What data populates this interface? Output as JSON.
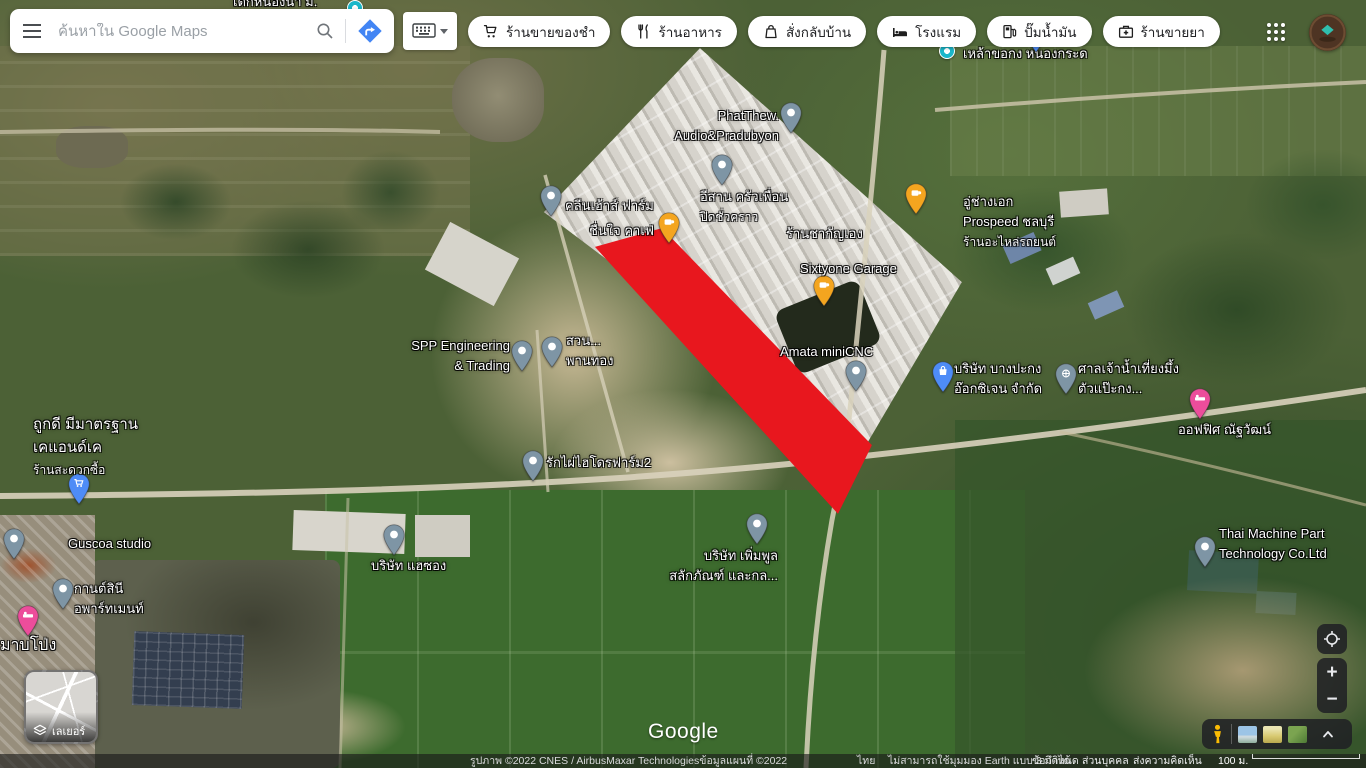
{
  "search": {
    "placeholder": "ค้นหาใน Google Maps"
  },
  "toolbar": {
    "chips": [
      {
        "label": "ร้านขายของชำ",
        "icon": "grocery-cart-icon"
      },
      {
        "label": "ร้านอาหาร",
        "icon": "restaurant-icon"
      },
      {
        "label": "สั่งกลับบ้าน",
        "icon": "takeout-bag-icon"
      },
      {
        "label": "โรงแรม",
        "icon": "hotel-bed-icon"
      },
      {
        "label": "ปั๊มน้ำมัน",
        "icon": "gas-pump-icon"
      },
      {
        "label": "ร้านขายยา",
        "icon": "pharmacy-icon"
      }
    ]
  },
  "map": {
    "watermark": "Google",
    "overlay_color": "#e8171e",
    "pin_colors": {
      "gray": "#7e95a5",
      "orange": "#f4a51f",
      "blue": "#4e8cf7",
      "pink": "#ec4d9b",
      "teal": "#1ab7c9"
    },
    "places": [
      {
        "id": "dek-nong-na",
        "lines": [
          "เดกหนองนา ม."
        ],
        "label": {
          "x": 233,
          "y": -8
        },
        "dot": {
          "x": 355,
          "y": 8,
          "color": "teal"
        }
      },
      {
        "id": "lao-chokong",
        "lines": [
          "เหล้าขอกง หนองกระด"
        ],
        "label": {
          "x": 963,
          "y": 44
        },
        "dot": {
          "x": 947,
          "y": 51,
          "color": "teal"
        }
      },
      {
        "id": "phatthew-audio",
        "lines": [
          "PhatThew.",
          "Audio&Pradubyon"
        ],
        "label": {
          "x": 779,
          "y": 106,
          "align": "right"
        },
        "pin": {
          "x": 791,
          "y": 133,
          "color": "gray",
          "glyph": "dot"
        }
      },
      {
        "id": "cleanhouse-farm",
        "lines": [
          "คลีนเฮ้าส์ ฟาร์ม"
        ],
        "label": {
          "x": 565,
          "y": 196
        },
        "pin": {
          "x": 551,
          "y": 216,
          "color": "gray",
          "glyph": "dot"
        }
      },
      {
        "id": "cheunjai-cafe",
        "lines": [
          "ชื่นใจ คาเฟ่"
        ],
        "label": {
          "x": 654,
          "y": 221,
          "align": "right"
        },
        "pin": {
          "x": 669,
          "y": 243,
          "color": "orange",
          "glyph": "coffee"
        }
      },
      {
        "id": "isan-krua-puen",
        "lines": [
          "อีสาน ครัวเพื่อน"
        ],
        "sub": "ปิดชั่วคราว",
        "label": {
          "x": 700,
          "y": 187
        },
        "pin": {
          "x": 722,
          "y": 185,
          "color": "gray",
          "glyph": "dot"
        }
      },
      {
        "id": "chakanyeng",
        "lines": [
          "ร้านชากัญเอง"
        ],
        "label": {
          "x": 786,
          "y": 224
        },
        "pin": {
          "x": 916,
          "y": 214,
          "color": "orange",
          "glyph": "coffee"
        }
      },
      {
        "id": "prospeed-chonburi",
        "lines": [
          "อู่ช่างเอก",
          "Prospeed ชลบุรี"
        ],
        "sub": "ร้านอะไหล่รถยนต์",
        "label": {
          "x": 963,
          "y": 192
        }
      },
      {
        "id": "sixtyone-garage",
        "lines": [
          "Sixtyone Garage"
        ],
        "label": {
          "x": 800,
          "y": 259
        },
        "pin": {
          "x": 824,
          "y": 306,
          "color": "orange",
          "glyph": "coffee"
        }
      },
      {
        "id": "amata-minicnc",
        "lines": [
          "Amata miniCNC"
        ],
        "label": {
          "x": 780,
          "y": 342
        },
        "pin": {
          "x": 856,
          "y": 391,
          "color": "gray",
          "glyph": "dot"
        }
      },
      {
        "id": "spp-engineering",
        "lines": [
          "SPP Engineering",
          "& Trading"
        ],
        "label": {
          "x": 510,
          "y": 336,
          "align": "right"
        },
        "pin": {
          "x": 522,
          "y": 371,
          "color": "gray",
          "glyph": "dot"
        }
      },
      {
        "id": "suan-phan-thong",
        "lines": [
          "สวน...",
          "พานทอง"
        ],
        "label": {
          "x": 566,
          "y": 331
        },
        "pin": {
          "x": 552,
          "y": 367,
          "color": "gray",
          "glyph": "dot"
        },
        "under_overlay": true
      },
      {
        "id": "bangpakong-oxygen",
        "lines": [
          "บริษัท บางปะกง",
          "อ๊อกซิเจน จำกัด"
        ],
        "label": {
          "x": 954,
          "y": 359
        },
        "pin": {
          "x": 943,
          "y": 392,
          "color": "blue",
          "glyph": "bag"
        }
      },
      {
        "id": "shrine-nam-thiang",
        "lines": [
          "ศาลเจ้าน้ำเที่ยงมึ้ง",
          "ตัวแป๊ะกง..."
        ],
        "label": {
          "x": 1078,
          "y": 359
        },
        "pin": {
          "x": 1066,
          "y": 394,
          "color": "gray",
          "glyph": "wheel"
        }
      },
      {
        "id": "office-natthawat",
        "lines": [
          "ออฟฟิศ ณัฐวัฒน์"
        ],
        "label": {
          "x": 1178,
          "y": 420
        },
        "pin": {
          "x": 1200,
          "y": 419,
          "color": "pink",
          "glyph": "bed"
        }
      },
      {
        "id": "tookdee-kandk",
        "lines": [
          "ถูกดี มีมาตรฐาน",
          "เคแอนด์เค"
        ],
        "sub": "ร้านสะดวกซื้อ",
        "label": {
          "x": 33,
          "y": 413,
          "size": 15
        },
        "pin": {
          "x": 79,
          "y": 504,
          "color": "blue",
          "glyph": "cart"
        }
      },
      {
        "id": "rakphai-hydrofarm2",
        "lines": [
          "รักไผ่ไฮโดรฟาร์ม2"
        ],
        "label": {
          "x": 546,
          "y": 453
        },
        "pin": {
          "x": 533,
          "y": 481,
          "color": "gray",
          "glyph": "dot"
        }
      },
      {
        "id": "permpoon-salakphan",
        "lines": [
          "บริษัท เพิ่มพูล",
          "สลักภัณฑ์ และกล..."
        ],
        "label": {
          "x": 778,
          "y": 546,
          "align": "right"
        },
        "pin": {
          "x": 757,
          "y": 544,
          "color": "gray",
          "glyph": "dot"
        }
      },
      {
        "id": "guscoa-studio",
        "lines": [
          "Guscoa studio"
        ],
        "label": {
          "x": 68,
          "y": 534
        },
        "pin": {
          "x": 14,
          "y": 559,
          "color": "gray",
          "glyph": "dot"
        }
      },
      {
        "id": "kansinee-apartment",
        "lines": [
          "กานต์สินี",
          "อพาร์ทเมนท์"
        ],
        "label": {
          "x": 74,
          "y": 579
        },
        "pin": {
          "x": 63,
          "y": 609,
          "color": "gray",
          "glyph": "dot"
        }
      },
      {
        "id": "lodging-pin",
        "lines": [],
        "pin": {
          "x": 28,
          "y": 636,
          "color": "pink",
          "glyph": "bed"
        }
      },
      {
        "id": "unnamed-blue-pin",
        "lines": [],
        "pin": {
          "x": 1036,
          "y": 52,
          "color": "blue",
          "glyph": "dot"
        }
      },
      {
        "id": "mab-pong",
        "lines": [
          "มาบโป่ง"
        ],
        "label": {
          "x": 0,
          "y": 634,
          "size": 16
        }
      },
      {
        "id": "haesong",
        "lines": [
          "บริษัท แฮซอง"
        ],
        "label": {
          "x": 371,
          "y": 556
        },
        "pin": {
          "x": 394,
          "y": 555,
          "color": "gray",
          "glyph": "dot"
        }
      },
      {
        "id": "thai-machine-part",
        "lines": [
          "Thai Machine Part",
          "Technology Co.Ltd"
        ],
        "label": {
          "x": 1219,
          "y": 524
        },
        "pin": {
          "x": 1205,
          "y": 567,
          "color": "gray",
          "glyph": "dot"
        }
      }
    ]
  },
  "layers_widget": {
    "label": "เลเยอร์"
  },
  "controls": {
    "zoom_in": "+",
    "zoom_out": "−"
  },
  "attribution": {
    "imagery": "รูปภาพ ©2022 CNES / AirbusMaxar Technologiesข้อมูลแผนที่ ©2022",
    "region": "ไทย",
    "notice": "ไม่สามารถใช้มุมมอง Earth แบบ 3 มิติได้",
    "terms": "ข้อกำหนด",
    "privacy": "ส่วนบุคคล",
    "feedback": "ส่งความคิดเห็น",
    "scale_label": "100 ม."
  }
}
